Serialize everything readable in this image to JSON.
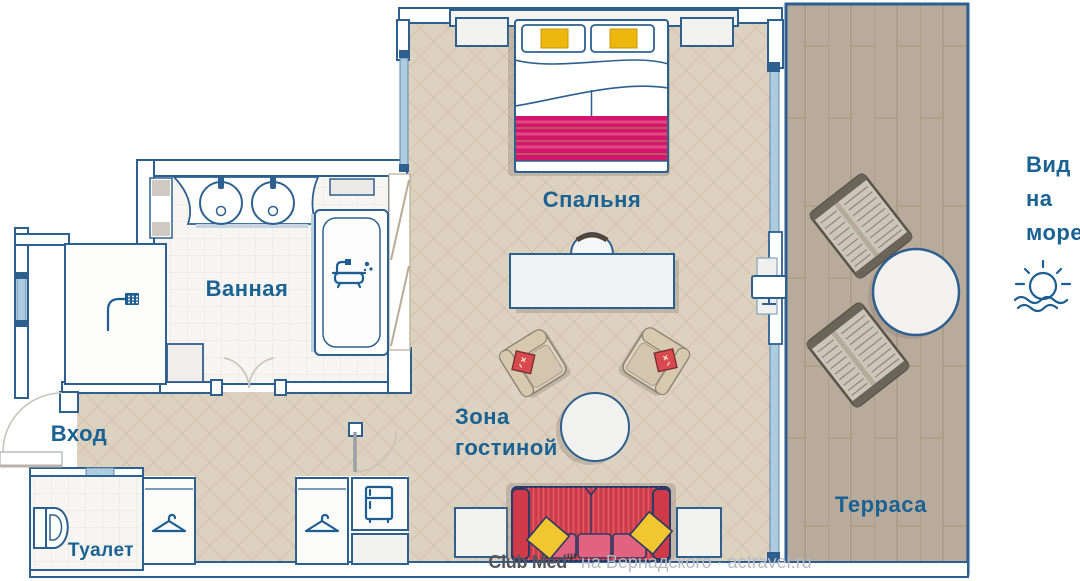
{
  "labels": {
    "bedroom": "Спальня",
    "bathroom": "Ванная",
    "entrance": "Вход",
    "toilet": "Туалет",
    "living_area_line1": "Зона",
    "living_area_line2": "гостиной",
    "terrace": "Терраса",
    "sea_view_line1": "Вид",
    "sea_view_line2": "на",
    "sea_view_line3": "море"
  },
  "watermark": {
    "brand": "Club Med",
    "trident_mark": "Ψ",
    "text": "на Вернадского · actravel.ru"
  },
  "icons": {
    "sun_over_sea": "sun-over-sea-icon",
    "shower": "shower-icon",
    "bathtub": "bathtub-icon",
    "toilet": "toilet-icon",
    "hanger": "hanger-icon",
    "fridge": "fridge-icon",
    "trident": "trident-icon"
  },
  "colors": {
    "wall_outline": "#2d608f",
    "label_text": "#1a6293",
    "floor_beige": "#ddd1c0",
    "floor_line": "#d2c3ae",
    "tile_floor": "#f7f5f1",
    "terrace_wood": "#b8ab9b",
    "terrace_border": "#2d5f8e",
    "glass": "#aeccdf",
    "bed_blanket": "#d3156d",
    "accent_yellow": "#edb70d",
    "sofa_red": "#d8414f",
    "sofa_cushion": "#e2637f",
    "sofa_pillow": "#f1c62f",
    "armchair_beige": "#e0d4bf",
    "icon_blue": "#1d5e92",
    "watermark_brand": "#55555c",
    "watermark_text": "#b6bac2"
  }
}
